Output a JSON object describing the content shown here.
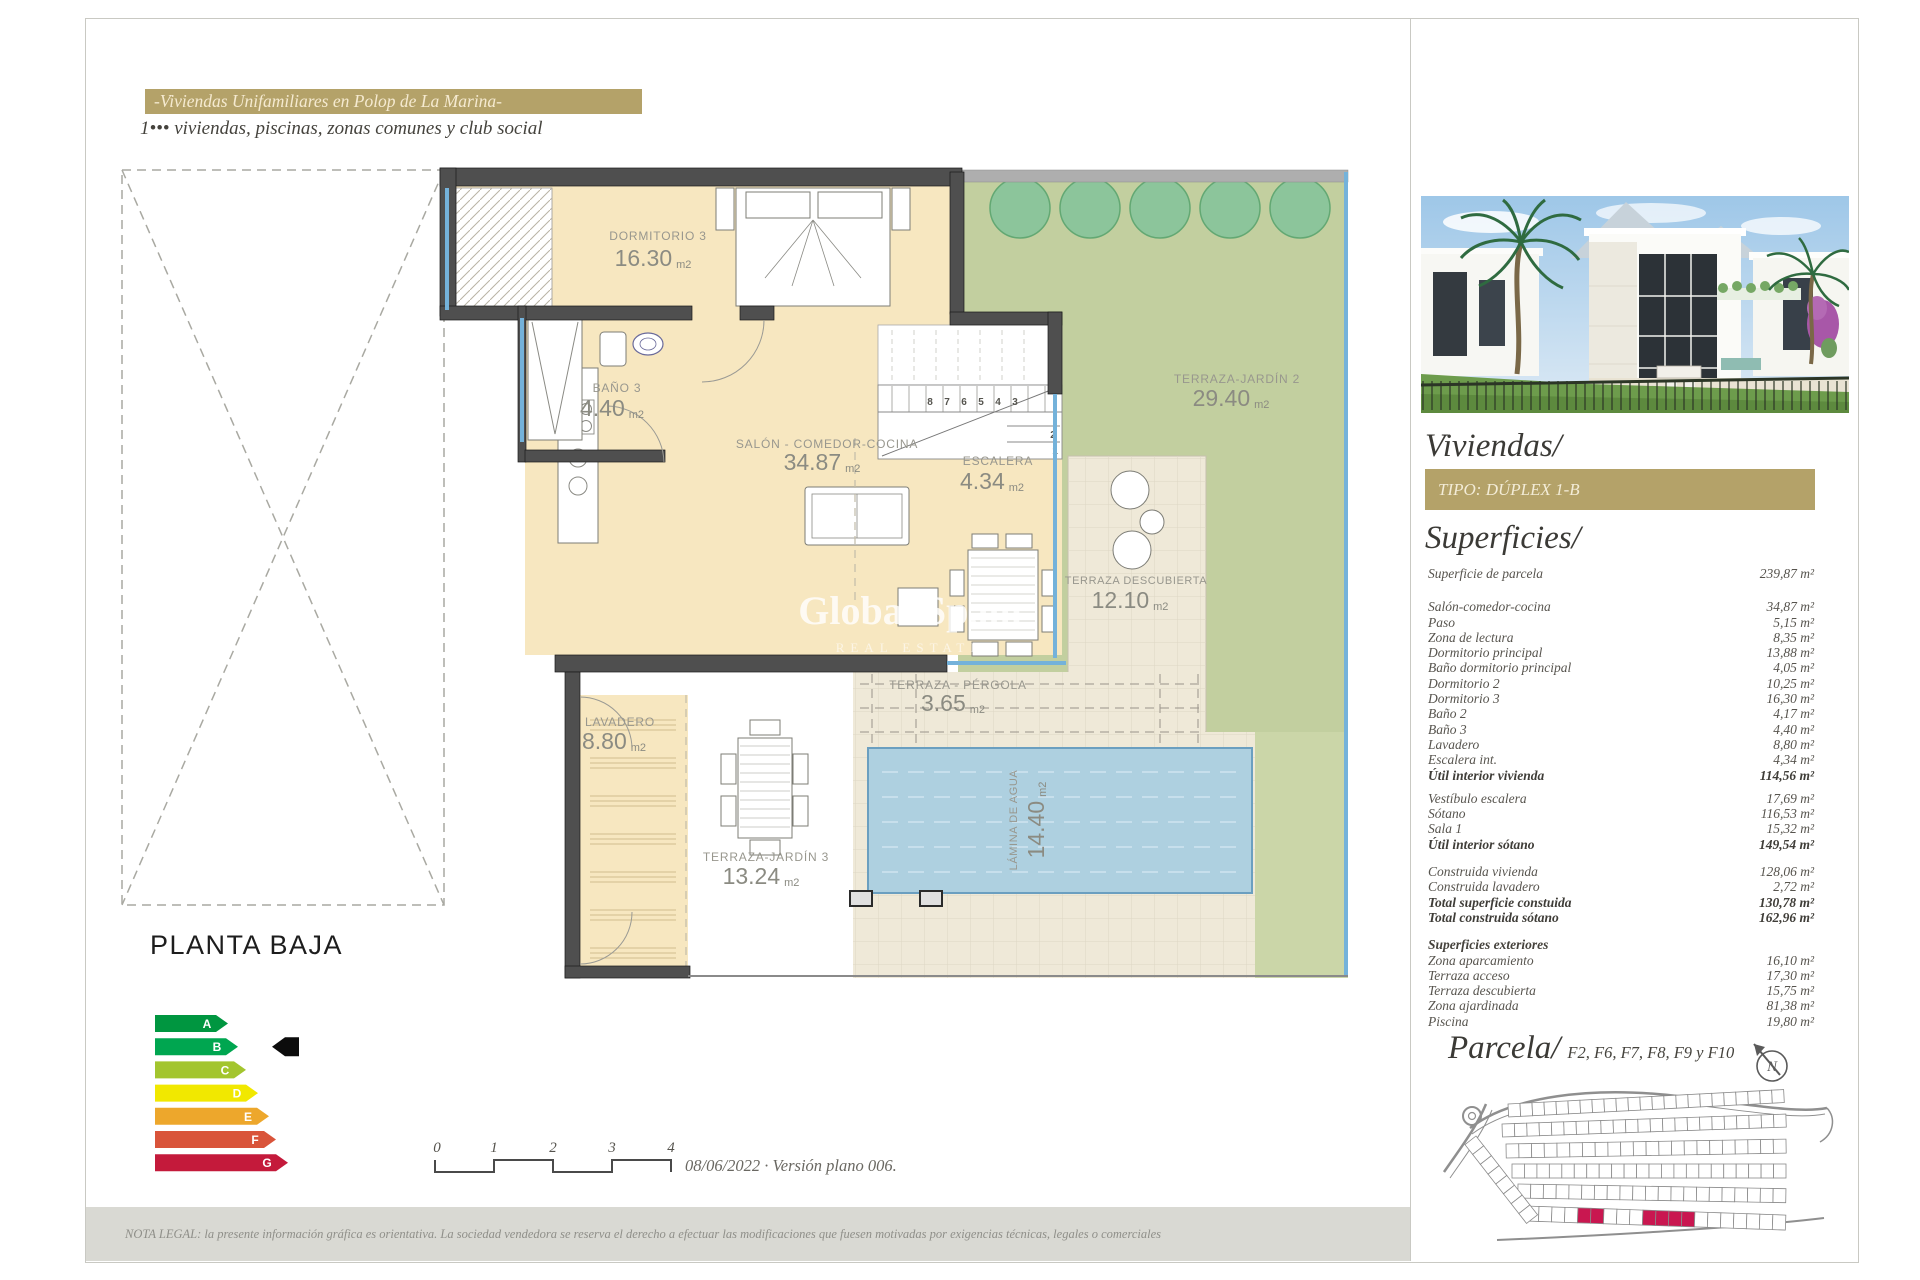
{
  "colors": {
    "gold": "#b4a269",
    "parcela_highlight": "#c91750"
  },
  "header": {
    "title": "-Viviendas Unifamiliares en Polop de La Marina-",
    "subtitle": "1••• viviendas, piscinas, zonas comunes y club social"
  },
  "plan": {
    "title": "PLANTA BAJA",
    "watermark_line1": "Global Spain",
    "watermark_line2": "REAL ESTATE",
    "rooms": {
      "dormitorio3": {
        "label": "DORMITORIO 3",
        "area": "16.30",
        "unit": "m2"
      },
      "bano3": {
        "label": "BAÑO 3",
        "area": "4.40",
        "unit": "m2"
      },
      "salon": {
        "label": "SALÓN - COMEDOR-COCINA",
        "area": "34.87",
        "unit": "m2"
      },
      "escalera": {
        "label": "ESCALERA",
        "area": "4.34",
        "unit": "m2"
      },
      "terraza_jardin2": {
        "label": "TERRAZA-JARDÍN 2",
        "area": "29.40",
        "unit": "m2"
      },
      "terraza_descubierta": {
        "label": "TERRAZA DESCUBIERTA",
        "area": "12.10",
        "unit": "m2"
      },
      "terraza_pergola": {
        "label": "TERRAZA - PÉRGOLA",
        "area": "3.65",
        "unit": "m2"
      },
      "lavadero": {
        "label": "LAVADERO",
        "area": "8.80",
        "unit": "m2"
      },
      "terraza_jardin3": {
        "label": "TERRAZA-JARDÍN 3",
        "area": "13.24",
        "unit": "m2"
      },
      "lamina_agua": {
        "label": "LÁMINA DE AGUA",
        "area": "14.40",
        "unit": "m2"
      }
    },
    "stairs": {
      "top": [
        "8",
        "7",
        "6",
        "5",
        "4",
        "3"
      ],
      "side": [
        "2",
        "1"
      ]
    }
  },
  "energy": {
    "levels": [
      {
        "letter": "A",
        "color": "#009640",
        "body": 61
      },
      {
        "letter": "B",
        "color": "#00a650",
        "body": 71
      },
      {
        "letter": "C",
        "color": "#a3c52e",
        "body": 79
      },
      {
        "letter": "D",
        "color": "#f1e800",
        "body": 91
      },
      {
        "letter": "E",
        "color": "#eda72c",
        "body": 102
      },
      {
        "letter": "F",
        "color": "#d9543a",
        "body": 109
      },
      {
        "letter": "G",
        "color": "#c41a3b",
        "body": 121
      }
    ],
    "marker_level": "B"
  },
  "scalebar": {
    "ticks": [
      "0",
      "1",
      "2",
      "3",
      "4"
    ],
    "caption": "08/06/2022 · Versión plano 006."
  },
  "sidebar": {
    "title": "Viviendas/",
    "type_badge": "TIPO: DÚPLEX 1-B",
    "superficies_title": "Superficies/",
    "groups": [
      {
        "rows": [
          {
            "label": "Superficie de parcela",
            "value": "239,87 m²"
          }
        ]
      },
      {
        "rows": [
          {
            "label": "Salón-comedor-cocina",
            "value": "34,87 m²"
          },
          {
            "label": "Paso",
            "value": "5,15 m²"
          },
          {
            "label": "Zona de lectura",
            "value": "8,35 m²"
          },
          {
            "label": "Dormitorio principal",
            "value": "13,88 m²"
          },
          {
            "label": "Baño dormitorio principal",
            "value": "4,05 m²"
          },
          {
            "label": "Dormitorio 2",
            "value": "10,25 m²"
          },
          {
            "label": "Dormitorio 3",
            "value": "16,30 m²"
          },
          {
            "label": "Baño 2",
            "value": "4,17 m²"
          },
          {
            "label": "Baño 3",
            "value": "4,40 m²"
          },
          {
            "label": "Lavadero",
            "value": "8,80 m²"
          },
          {
            "label": "Escalera int.",
            "value": "4,34 m²"
          },
          {
            "label": "Útil interior vivienda",
            "value": "114,56 m²",
            "bold": true
          }
        ]
      },
      {
        "rows": [
          {
            "label": "Vestíbulo escalera",
            "value": "17,69 m²"
          },
          {
            "label": "Sótano",
            "value": "116,53 m²"
          },
          {
            "label": "Sala 1",
            "value": "15,32 m²"
          },
          {
            "label": "Útil interior sótano",
            "value": "149,54 m²",
            "bold": true
          }
        ]
      },
      {
        "rows": [
          {
            "label": "Construida vivienda",
            "value": "128,06 m²"
          },
          {
            "label": "Construida lavadero",
            "value": "2,72 m²"
          },
          {
            "label": "Total superficie constuida",
            "value": "130,78 m²",
            "bold": true
          },
          {
            "label": "Total construida sótano",
            "value": "162,96 m²",
            "bold": true
          }
        ]
      },
      {
        "header": "Superficies exteriores",
        "rows": [
          {
            "label": "Zona aparcamiento",
            "value": "16,10 m²"
          },
          {
            "label": "Terraza acceso",
            "value": "17,30 m²"
          },
          {
            "label": "Terraza descubierta",
            "value": "15,75 m²"
          },
          {
            "label": "Zona ajardinada",
            "value": "81,38 m²"
          },
          {
            "label": "Piscina",
            "value": "19,80 m²"
          }
        ]
      }
    ],
    "parcela_title": "Parcela/",
    "parcela_subtitle": "F2, F6, F7, F8, F9 y F10",
    "compass_letter": "N"
  },
  "footer": {
    "legal": "NOTA LEGAL: la presente información gráfica es orientativa. La sociedad vendedora se reserva el derecho a efectuar las modificaciones que fuesen motivadas por exigencias técnicas, legales o comerciales"
  }
}
